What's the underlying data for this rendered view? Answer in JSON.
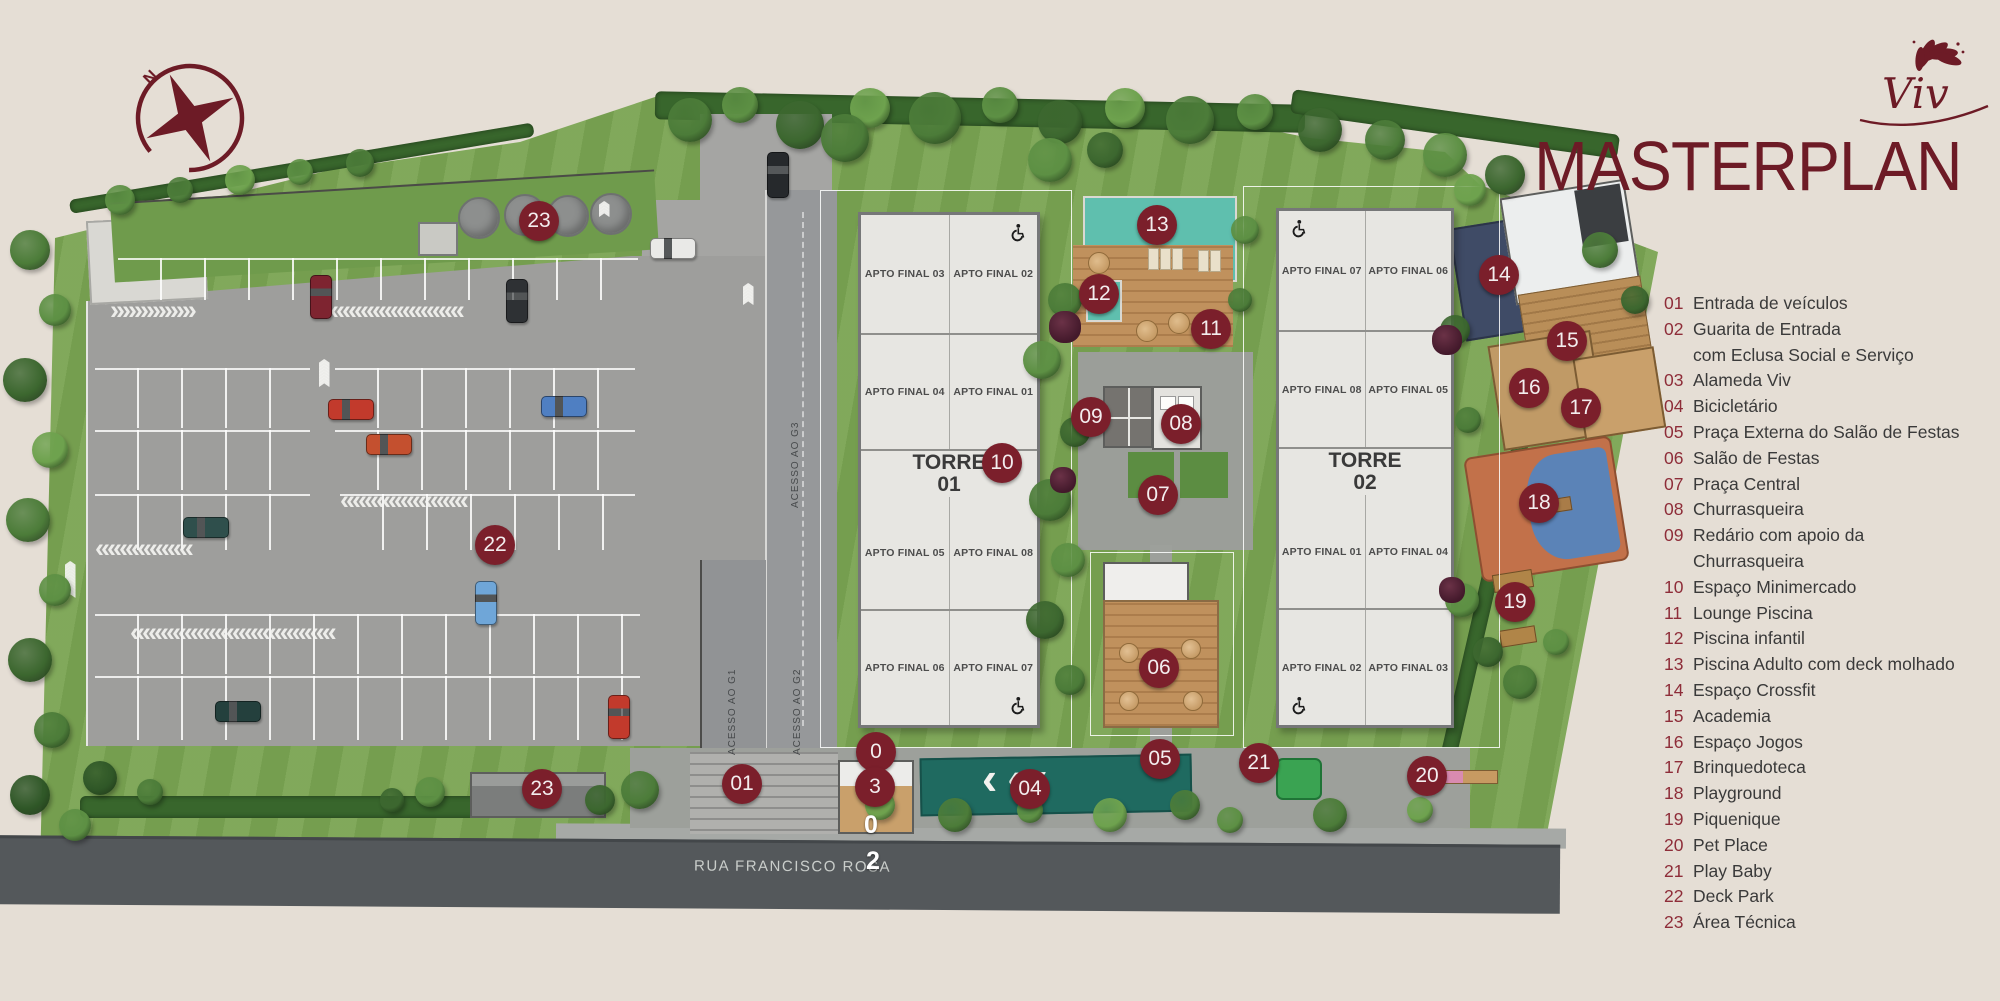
{
  "colors": {
    "accent": "#6d1b26",
    "badge": "#7b1f2b",
    "background": "#e5ded5",
    "legend_number": "#8e2d39",
    "grass": "#7aa452",
    "pool": "#5fbfae"
  },
  "branding": {
    "logo_text": "Viv",
    "title": "MASTERPLAN"
  },
  "compass": {
    "label": "N"
  },
  "legend": {
    "items": [
      {
        "num": "01",
        "label": "Entrada de veículos"
      },
      {
        "num": "02",
        "label": "Guarita de Entrada",
        "label2": "com Eclusa Social e Serviço"
      },
      {
        "num": "03",
        "label": "Alameda Viv"
      },
      {
        "num": "04",
        "label": "Bicicletário"
      },
      {
        "num": "05",
        "label": "Praça Externa do Salão de Festas"
      },
      {
        "num": "06",
        "label": "Salão de Festas"
      },
      {
        "num": "07",
        "label": "Praça Central"
      },
      {
        "num": "08",
        "label": "Churrasqueira"
      },
      {
        "num": "09",
        "label": "Redário com apoio da",
        "label2": "Churrasqueira"
      },
      {
        "num": "10",
        "label": "Espaço Minimercado"
      },
      {
        "num": "11",
        "label": "Lounge Piscina"
      },
      {
        "num": "12",
        "label": "Piscina infantil"
      },
      {
        "num": "13",
        "label": "Piscina Adulto com deck molhado"
      },
      {
        "num": "14",
        "label": "Espaço Crossfit"
      },
      {
        "num": "15",
        "label": "Academia"
      },
      {
        "num": "16",
        "label": "Espaço Jogos"
      },
      {
        "num": "17",
        "label": "Brinquedoteca"
      },
      {
        "num": "18",
        "label": "Playground"
      },
      {
        "num": "19",
        "label": "Piquenique"
      },
      {
        "num": "20",
        "label": "Pet Place"
      },
      {
        "num": "21",
        "label": "Play Baby"
      },
      {
        "num": "22",
        "label": "Deck Park"
      },
      {
        "num": "23",
        "label": "Área Técnica"
      }
    ]
  },
  "map": {
    "street_name": "RUA FRANCISCO ROSA",
    "access_labels": [
      {
        "label": "ACESSO AO G1",
        "x": 733,
        "y": 655
      },
      {
        "label": "ACESSO AO G2",
        "x": 798,
        "y": 655
      },
      {
        "label": "ACESSO AO G3",
        "x": 796,
        "y": 408
      }
    ],
    "towers": [
      {
        "name": "TORRE",
        "number": "01",
        "units_rows": [
          [
            "APTO FINAL 03",
            "APTO FINAL 02"
          ],
          [
            "APTO FINAL 04",
            "APTO FINAL 01"
          ],
          [
            "APTO FINAL 05",
            "APTO FINAL 08"
          ],
          [
            "APTO FINAL 06",
            "APTO FINAL 07"
          ]
        ]
      },
      {
        "name": "TORRE",
        "number": "02",
        "units_rows": [
          [
            "APTO FINAL 07",
            "APTO FINAL 06"
          ],
          [
            "APTO FINAL 08",
            "APTO FINAL 05"
          ],
          [
            "APTO FINAL 01",
            "APTO FINAL 04"
          ],
          [
            "APTO FINAL 02",
            "APTO FINAL 03"
          ]
        ]
      }
    ],
    "markers": [
      {
        "label": "23",
        "x": 539,
        "y": 221
      },
      {
        "label": "22",
        "x": 495,
        "y": 545
      },
      {
        "label": "23",
        "x": 542,
        "y": 789
      },
      {
        "label": "01",
        "x": 742,
        "y": 784
      },
      {
        "label": "0",
        "x": 876,
        "y": 752
      },
      {
        "label": "3",
        "x": 875,
        "y": 787
      },
      {
        "label": "04",
        "x": 1030,
        "y": 789
      },
      {
        "label": "05",
        "x": 1160,
        "y": 759
      },
      {
        "label": "06",
        "x": 1159,
        "y": 668
      },
      {
        "label": "07",
        "x": 1158,
        "y": 495
      },
      {
        "label": "08",
        "x": 1181,
        "y": 424
      },
      {
        "label": "09",
        "x": 1091,
        "y": 417
      },
      {
        "label": "10",
        "x": 1002,
        "y": 463
      },
      {
        "label": "11",
        "x": 1211,
        "y": 329
      },
      {
        "label": "12",
        "x": 1099,
        "y": 294
      },
      {
        "label": "13",
        "x": 1157,
        "y": 225
      },
      {
        "label": "14",
        "x": 1499,
        "y": 275
      },
      {
        "label": "15",
        "x": 1567,
        "y": 341
      },
      {
        "label": "16",
        "x": 1529,
        "y": 388
      },
      {
        "label": "17",
        "x": 1581,
        "y": 408
      },
      {
        "label": "18",
        "x": 1539,
        "y": 503
      },
      {
        "label": "19",
        "x": 1515,
        "y": 602
      },
      {
        "label": "20",
        "x": 1427,
        "y": 776
      },
      {
        "label": "21",
        "x": 1259,
        "y": 763
      }
    ],
    "plain_markers": [
      {
        "label": "0",
        "x": 871,
        "y": 826
      },
      {
        "label": "2",
        "x": 873,
        "y": 862
      }
    ]
  }
}
